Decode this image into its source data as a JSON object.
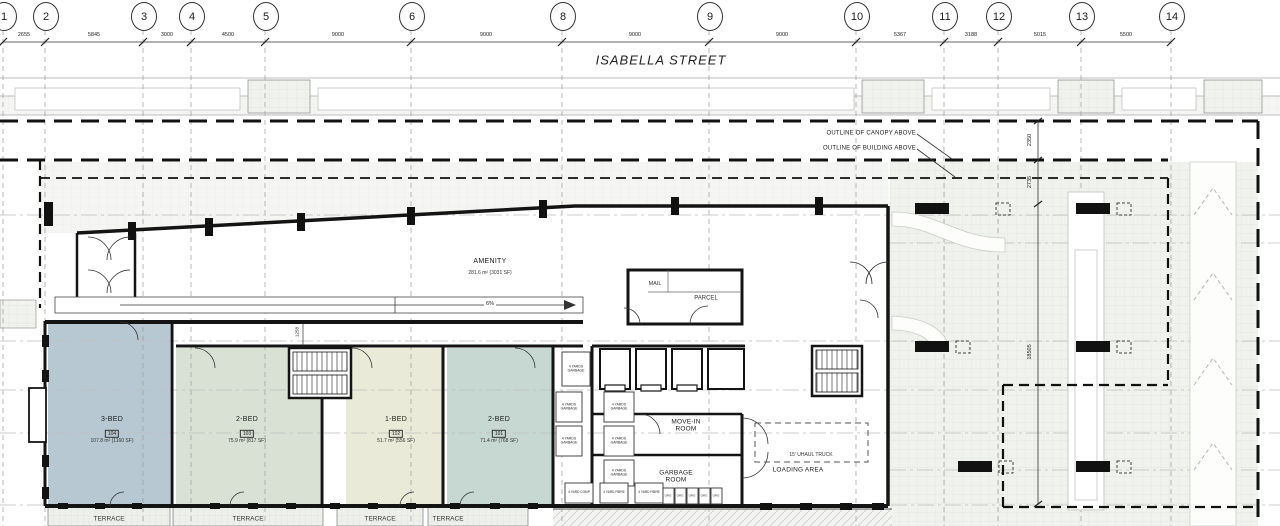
{
  "street": {
    "name": "ISABELLA STREET"
  },
  "grid": {
    "bubbles": [
      {
        "n": "1"
      },
      {
        "n": "2"
      },
      {
        "n": "3"
      },
      {
        "n": "4"
      },
      {
        "n": "5"
      },
      {
        "n": "6"
      },
      {
        "n": "8"
      },
      {
        "n": "9"
      },
      {
        "n": "10"
      },
      {
        "n": "11"
      },
      {
        "n": "12"
      },
      {
        "n": "13"
      },
      {
        "n": "14"
      }
    ],
    "dims": [
      {
        "v": "2655"
      },
      {
        "v": "5845"
      },
      {
        "v": "3000"
      },
      {
        "v": "4500"
      },
      {
        "v": "9000"
      },
      {
        "v": "9000"
      },
      {
        "v": "9000"
      },
      {
        "v": "9000"
      },
      {
        "v": "5367"
      },
      {
        "v": "3188"
      },
      {
        "v": "5015"
      },
      {
        "v": "5500"
      }
    ]
  },
  "vdims": [
    {
      "v": "2350"
    },
    {
      "v": "2735"
    },
    {
      "v": "18505"
    }
  ],
  "callouts": {
    "canopy": "OUTLINE OF CANOPY ABOVE",
    "building": "OUTLINE OF BUILDING ABOVE"
  },
  "amenity": {
    "name": "AMENITY",
    "area": "281.6 m² (3031 SF)",
    "ramp_slope": "6%"
  },
  "mailroom": {
    "mail": "MAIL",
    "parcel": "PARCEL"
  },
  "units": [
    {
      "name": "3-BED",
      "id": "104",
      "area": "107.8 m² (1160 SF)",
      "color": "#b8c8d2"
    },
    {
      "name": "2-BED",
      "id": "103",
      "area": "75.9 m² (817 SF)",
      "color": "#d9e1d4"
    },
    {
      "name": "1-BED",
      "id": "102",
      "area": "51.7 m² (556 SF)",
      "color": "#eaead9"
    },
    {
      "name": "2-BED",
      "id": "101",
      "area": "71.4 m² (768 SF)",
      "color": "#c7d8d2"
    }
  ],
  "core": {
    "move_in": "MOVE-IN ROOM",
    "garbage": "GARBAGE ROOM",
    "loading": "LOADING AREA",
    "truck": "15' UHAUL TRUCK"
  },
  "bins": {
    "large": "4 YARDS GARBAGE",
    "comp": "4 YARD COMP",
    "fibre": "4 YARD FIBRE",
    "small": "ORG"
  },
  "terraces": [
    {
      "label": "TERRACE"
    },
    {
      "label": "TERRACE"
    },
    {
      "label": "TERRACE"
    },
    {
      "label": "TERRACE"
    }
  ],
  "dims_misc": {
    "corridor": "1258"
  }
}
